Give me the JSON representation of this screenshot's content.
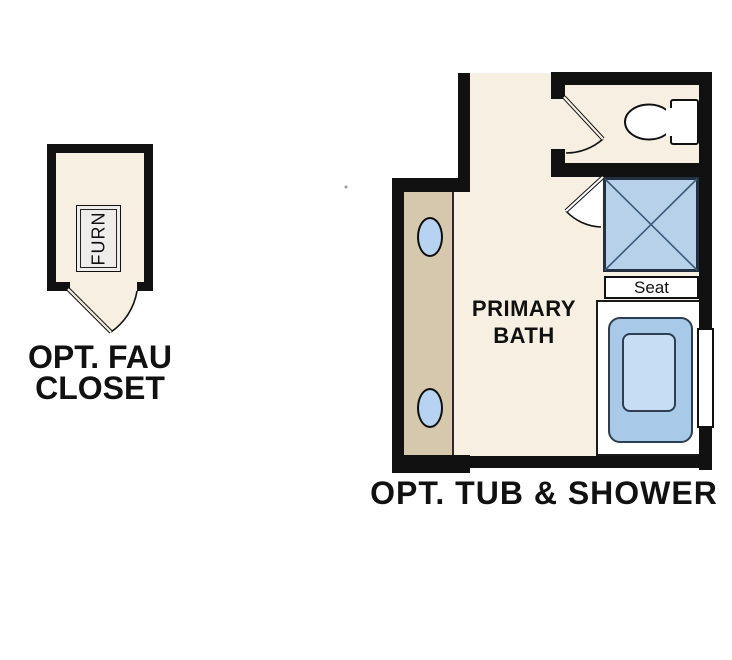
{
  "type": "architectural-floor-plan",
  "labels": {
    "fau_closet_line1": "OPT. FAU",
    "fau_closet_line2": "CLOSET",
    "furnace": "FURN",
    "bath_line1": "PRIMARY",
    "bath_line2": "BATH",
    "seat": "Seat",
    "bottom_title": "OPT. TUB & SHOWER"
  },
  "fixtures": [
    {
      "name": "furnace-unit",
      "label": "FURN"
    },
    {
      "name": "closet-door-swing"
    },
    {
      "name": "toilet"
    },
    {
      "name": "toilet-room-door-swing"
    },
    {
      "name": "shower-stall-with-x"
    },
    {
      "name": "shower-door-swing"
    },
    {
      "name": "shower-seat",
      "label": "Seat"
    },
    {
      "name": "bathtub-in-platform"
    },
    {
      "name": "vanity-counter"
    },
    {
      "name": "sink-oval-left-top"
    },
    {
      "name": "sink-oval-left-bottom"
    },
    {
      "name": "window-right-wall"
    }
  ],
  "colors": {
    "floor_cream": "#f6efe2",
    "vanity_tan": "#d5c8ac",
    "wall_black": "#111111",
    "shower_blue": "#b8d1ea",
    "tub_blue_outer": "#a9c9e9",
    "tub_blue_inner": "#c6ddf3",
    "sink_blue": "#b7d3f1",
    "fixture_outline": "#233040",
    "text_black": "#111111"
  }
}
